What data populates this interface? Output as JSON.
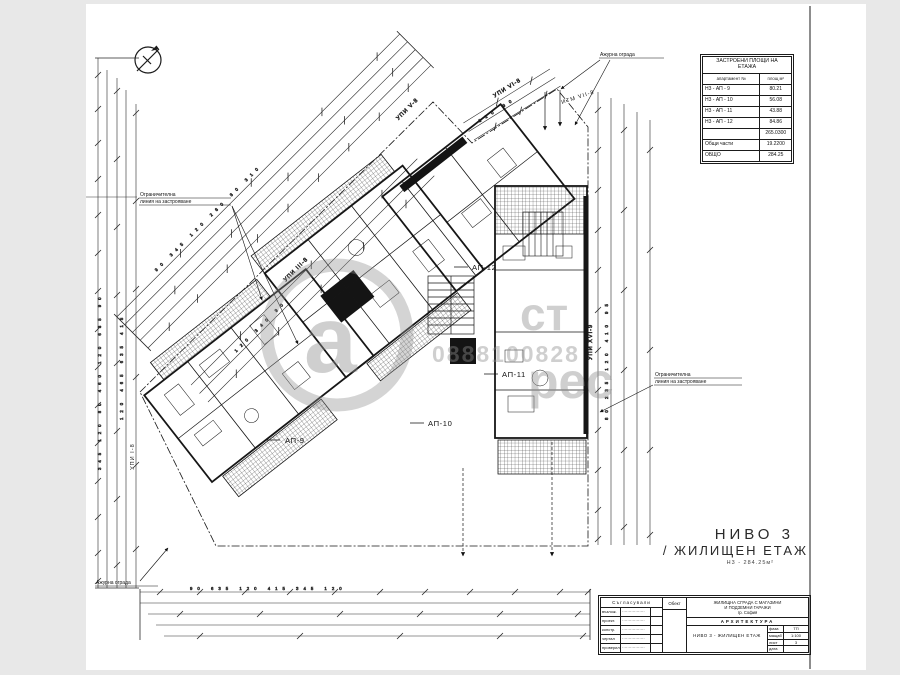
{
  "colors": {
    "ink": "#1b1b1b",
    "paper": "#ffffff",
    "canvas": "#e8e8e8",
    "watermark_grey": "#8f8f8f"
  },
  "main_title": {
    "line1": "НИВО 3",
    "line2": "/ ЖИЛИЩЕН ЕТАЖ",
    "subtitle": "Н3 - 284.25м²"
  },
  "area_table": {
    "title_line1": "ЗАСТРОЕНИ ПЛОЩИ НА",
    "title_line2": "ЕТАЖА",
    "col_label": "апартамент №",
    "col_value": "площ м²",
    "rows": [
      {
        "label": "Н3 - АП - 9",
        "value": "80.21"
      },
      {
        "label": "Н3 - АП - 10",
        "value": "56.08"
      },
      {
        "label": "Н3 - АП - 11",
        "value": "43.88"
      },
      {
        "label": "Н3 - АП - 12",
        "value": "84.86"
      },
      {
        "label": "",
        "value": "265.0300"
      },
      {
        "label": "Общи части",
        "value": "19.2200"
      },
      {
        "label": "ОБЩО",
        "value": "284.25"
      }
    ]
  },
  "plan_labels": {
    "ap9": "АП-9",
    "ap10": "АП-10",
    "ap11": "АП-11",
    "ap12": "АП-12",
    "upi_left": "УПИ І-8",
    "upi_diag": "УПИ ІІІ-8",
    "upi_top": "УПИ V-8",
    "upi_topright": "УПИ VІ-8",
    "itm": "ИТМ VІІ-8",
    "upi_right": "УПИ ХVІ-9"
  },
  "annotations": {
    "restriction_line1": "Ограничителна",
    "restriction_line2": "линия на застрояване",
    "fence": "Ажурна ограда"
  },
  "dim_numbers": {
    "left1": "345 120 80 460 120 635 90",
    "left2": "120 465 635 415",
    "top": "90 345 120 260 80 310",
    "inner": "120 340 90",
    "topright": "120 90",
    "right1": "80 235 120 410 95",
    "bottom1": "90 635 120 415 345 120"
  },
  "watermark": {
    "logo_letter": "а",
    "word_top": "ст",
    "phone": "0888100828",
    "word_bottom": "рес"
  },
  "title_block": {
    "approvals_header": "Съгласували",
    "rows": [
      {
        "role": "възлож.",
        "name": "·················"
      },
      {
        "role": "проект.",
        "name": "·················"
      },
      {
        "role": "констр.",
        "name": "·················"
      },
      {
        "role": "чертал",
        "name": "·················"
      },
      {
        "role": "проверил",
        "name": "·················"
      }
    ],
    "object_label": "Обект",
    "project_line1": "ЖИЛИЩНА СГРАДА С МАГАЗИНИ",
    "project_line2": "И ПОДЗЕМНИ ГАРАЖИ",
    "project_line3": "гр. София",
    "part_label": "АРХИТЕКТУРА",
    "drawing_name": "НИВО 3 - ЖИЛИЩЕН ЕТАЖ",
    "cells": [
      {
        "k": "фаза",
        "v": "ТП"
      },
      {
        "k": "мащаб",
        "v": "1:100"
      },
      {
        "k": "лист",
        "v": "3"
      },
      {
        "k": "дата",
        "v": ""
      }
    ]
  }
}
